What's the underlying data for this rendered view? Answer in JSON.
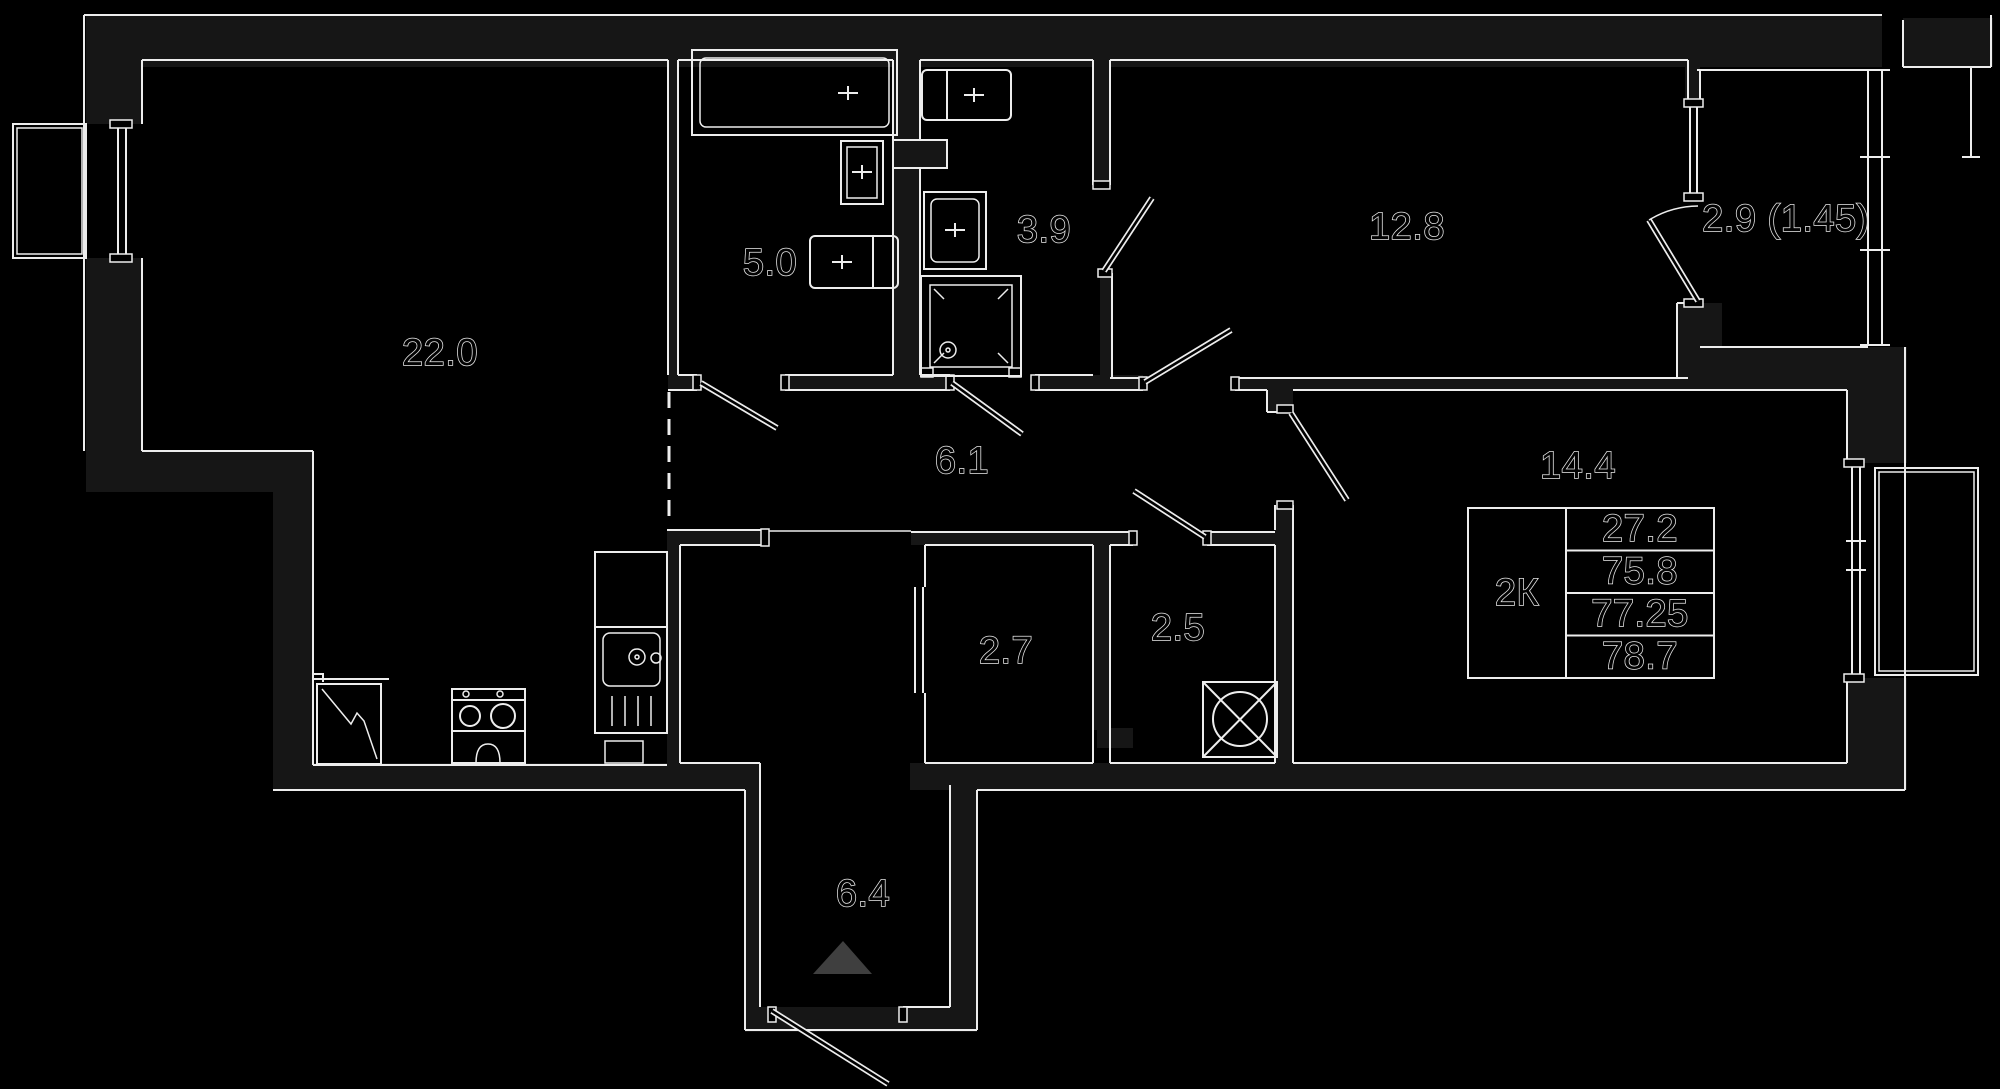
{
  "plan": {
    "rooms": [
      {
        "id": "living-kitchen",
        "label": "22.0"
      },
      {
        "id": "bathroom",
        "label": "5.0"
      },
      {
        "id": "shower-room",
        "label": "3.9"
      },
      {
        "id": "bedroom-1",
        "label": "12.8"
      },
      {
        "id": "balcony",
        "label": "2.9 (1.45)"
      },
      {
        "id": "hallway",
        "label": "6.1"
      },
      {
        "id": "bedroom-2",
        "label": "14.4"
      },
      {
        "id": "wardrobe",
        "label": "2.7"
      },
      {
        "id": "laundry",
        "label": "2.5"
      },
      {
        "id": "entry-hall",
        "label": "6.4"
      }
    ],
    "info_table": {
      "type_label": "2К",
      "rows": [
        {
          "value": "27.2"
        },
        {
          "value": "75.8"
        },
        {
          "value": "77.25"
        },
        {
          "value": "78.7"
        }
      ]
    },
    "colors": {
      "background": "#000000",
      "line": "#ededed",
      "wall_fill": "#161616",
      "entrance_arrow_fill": "#3f3f3f"
    }
  }
}
